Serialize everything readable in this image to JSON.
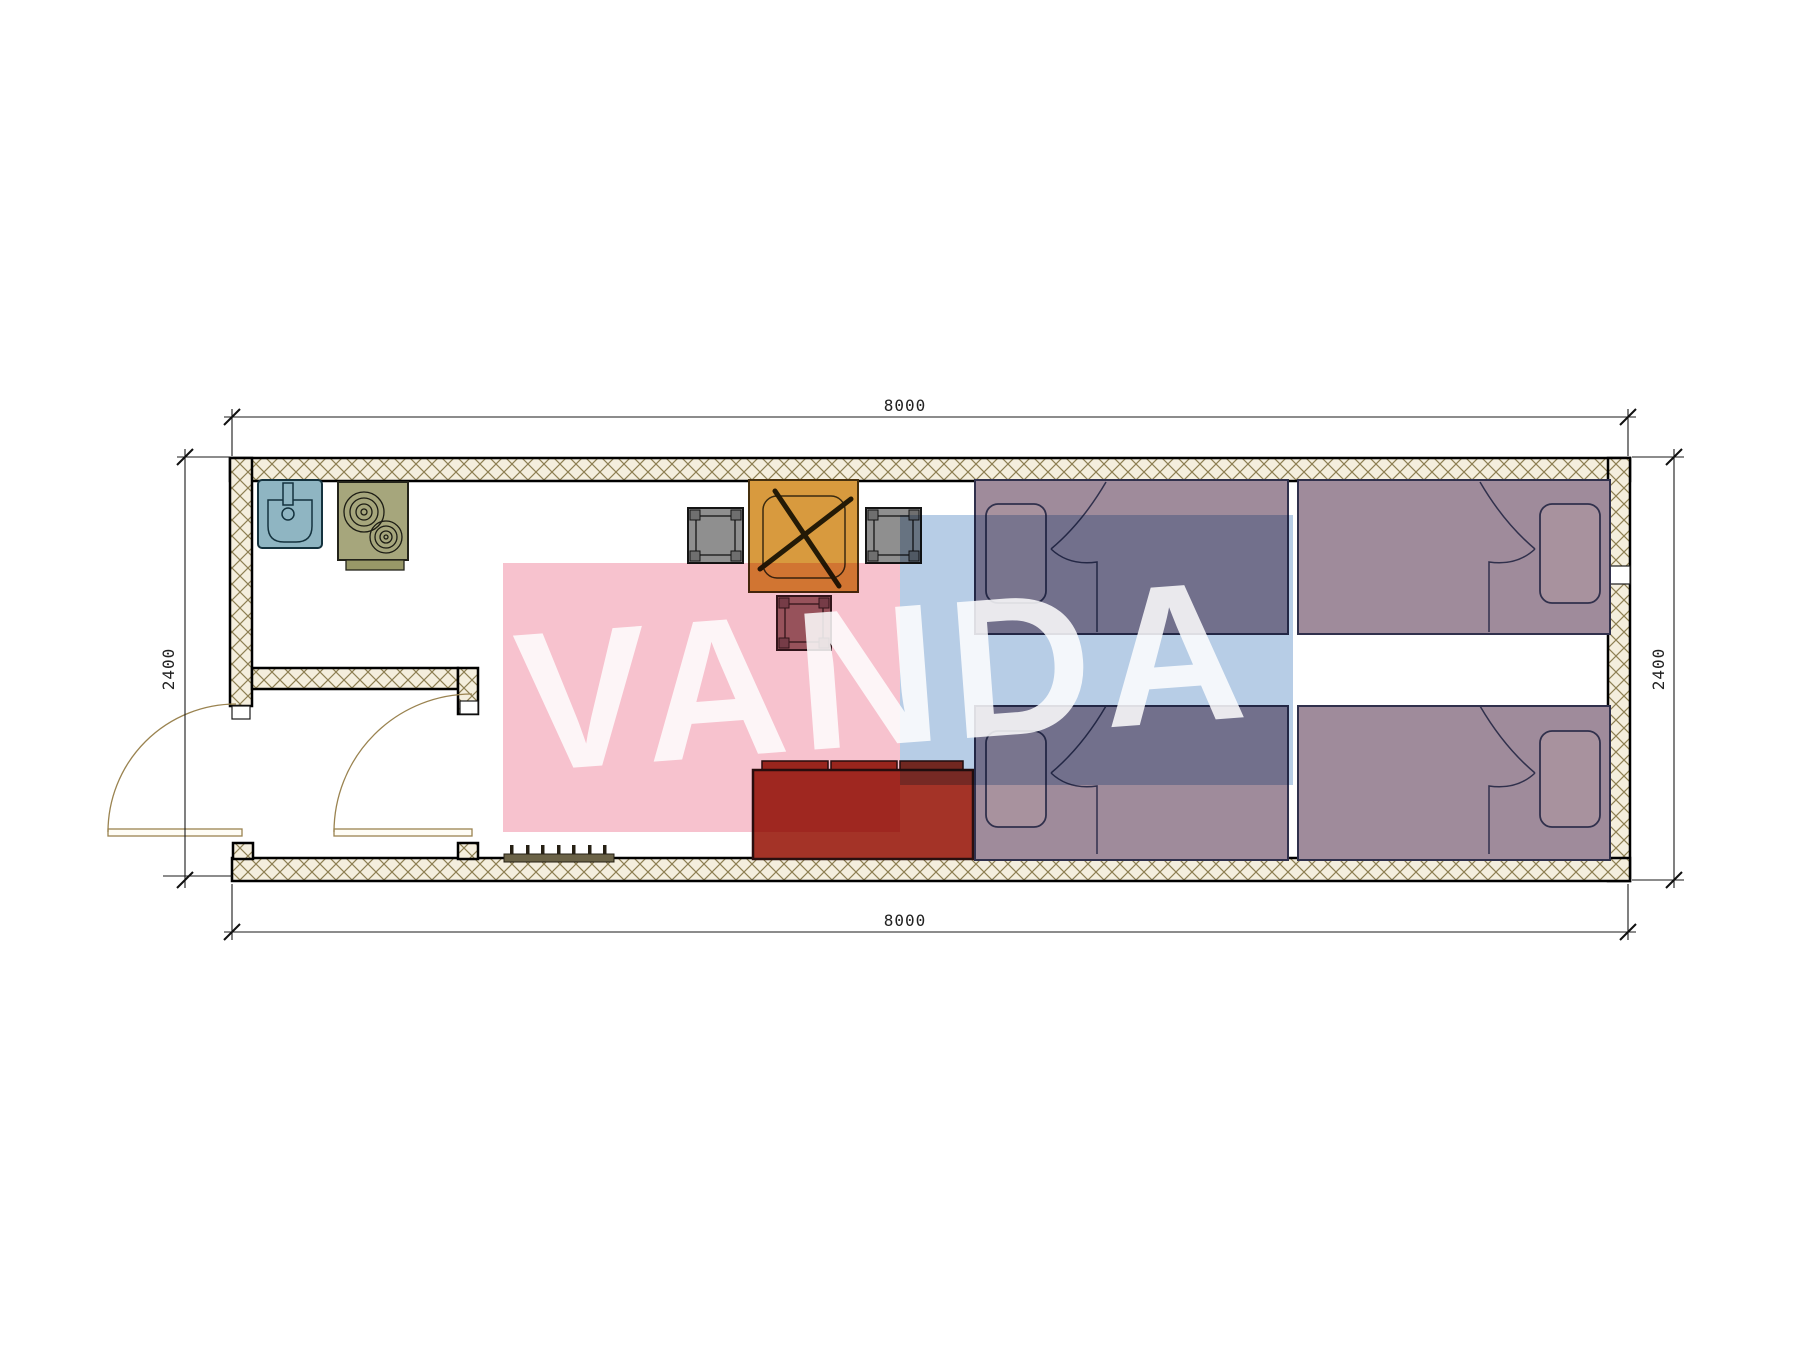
{
  "watermark": {
    "text": "VANDA",
    "pink_color": "#f7c2ce",
    "blue_color": "#b7cde6"
  },
  "dimensions": {
    "top": "8000",
    "bottom": "8000",
    "left": "2400",
    "right": "2400"
  },
  "plan": {
    "type": "container-house floor plan, top view",
    "wall_fill": "#f4eedd",
    "wall_hatch_color": "#8d7f52",
    "furniture": [
      {
        "name": "sink",
        "color": "#8fb5c2"
      },
      {
        "name": "stove-two-burners",
        "color": "#a6a67c"
      },
      {
        "name": "dining-table-x-base",
        "color": "#d89a3e"
      },
      {
        "name": "chair-left",
        "color": "#8f8f8f"
      },
      {
        "name": "chair-right",
        "color": "#8f8f8f"
      },
      {
        "name": "stool",
        "color": "#9c6b70"
      },
      {
        "name": "sofa-three-cushions",
        "color": "#a43327"
      },
      {
        "name": "bed-top-left",
        "color": "#9f8b9b"
      },
      {
        "name": "bed-top-right",
        "color": "#9f8b9b"
      },
      {
        "name": "bed-bottom-left",
        "color": "#9f8b9b"
      },
      {
        "name": "bed-bottom-right",
        "color": "#9f8b9b"
      },
      {
        "name": "entry-door-swing",
        "color": "#9a8350"
      },
      {
        "name": "interior-door-swing",
        "color": "#9a8350"
      },
      {
        "name": "doormat-grille",
        "color": "#6b6347"
      }
    ]
  }
}
